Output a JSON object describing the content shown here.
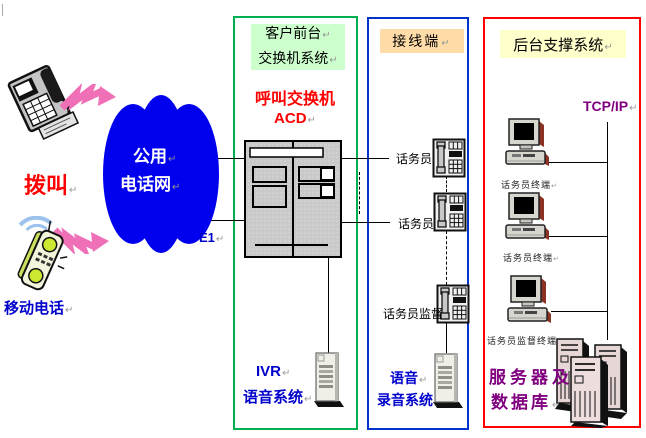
{
  "pstn": {
    "dial_label": "拨叫",
    "cloud_line1": "公用",
    "cloud_line2": "电话网",
    "mobile_label": "移动电话",
    "e1_label": "E1"
  },
  "front_system": {
    "title_line1": "客户前台",
    "title_line2": "交换机系统",
    "acd_title_line1": "呼叫交换机",
    "acd_title_line2": "ACD",
    "ivr_label_line1": "IVR",
    "ivr_label_line2": "语音系统"
  },
  "terminal_box": {
    "title": "接线端",
    "operator1_label": "话务员",
    "operator2_label": "话务员",
    "supervisor_label": "话务员监督",
    "recorder_line1": "语音",
    "recorder_line2": "录音系统"
  },
  "backend_box": {
    "title": "后台支撑系统",
    "protocol_label": "TCP/IP",
    "terminal1_label": "话务员终端",
    "terminal2_label": "话务员终端",
    "supervisor_terminal_label": "话务员监督终端",
    "server_line1": "服务器及",
    "server_line2": "数据库"
  },
  "paragraph_mark": "↵",
  "colors": {
    "cloud_fill": "#0000EE",
    "front_box_border": "#00B050",
    "terminal_box_border": "#0033CC",
    "backend_box_border": "#FF0000",
    "front_label_bg": "#CCFFCC",
    "terminal_label_bg": "#FFDCA8",
    "backend_label_bg": "#FFFFCC",
    "red_text": "#FF0000",
    "blue_text": "#0000CC",
    "purple_text": "#800080",
    "arrow_pink": "#F070B8",
    "switch_gray": "#C9C9C9"
  }
}
